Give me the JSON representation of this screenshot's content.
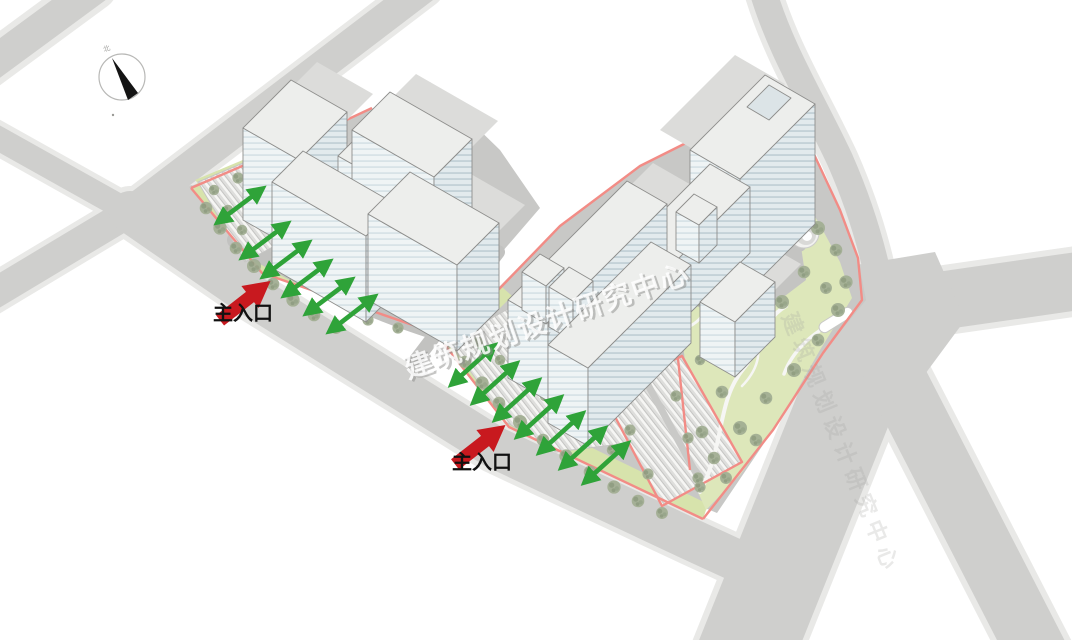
{
  "site_plan": {
    "labels": {
      "main_entrance": "主入口",
      "watermark": "建筑规划设计研究中心",
      "compass_north": "北"
    },
    "colors": {
      "entrance_arrow_red": "#c8191f",
      "axis_arrow_green": "#2fa339",
      "site_boundary_pink": "#f28c86",
      "road_gray": "#cfcfcd",
      "sidewalk_gray": "#e9e9e7",
      "parcel_gray": "#c8c8c6",
      "lawn_green": "#dde7ba",
      "tree_green": "#9dab90",
      "building_roof": "#edeeec",
      "building_facade": "#e2eaed",
      "shadow_gray": "#dcdcda",
      "watermark_gray": "#8d8d8b"
    }
  }
}
